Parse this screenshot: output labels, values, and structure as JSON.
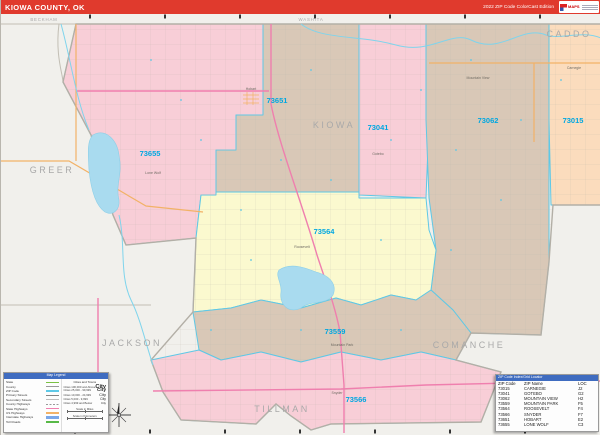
{
  "header": {
    "title": "KIOWA COUNTY, OK",
    "edition": "2022 ZIP Code ColorCast Edition",
    "logo_text": "MAPS"
  },
  "map": {
    "zip_labels": [
      "73651",
      "73041",
      "73062",
      "73015",
      "73655",
      "73564",
      "73559",
      "73566"
    ],
    "counties": [
      "BECKHAM",
      "WASHITA",
      "CADDO",
      "GREER",
      "KIOWA",
      "JACKSON",
      "TILLMAN",
      "COMANCHE"
    ],
    "towns": [
      "Hobart",
      "Lone Wolf",
      "Gotebo",
      "Mountain View",
      "Carnegie",
      "Roosevelt",
      "Mountain Park",
      "Snyder"
    ]
  },
  "legend": {
    "title": "Map Legend",
    "line_labels": [
      "State",
      "County",
      "ZIP Code",
      "Primary Streets",
      "Secondary Streets",
      "County Highways",
      "State Highways",
      "US Highways",
      "Interstate Highways",
      "Toll Roads"
    ],
    "cities_title": "Cities and Towns",
    "city_rows": [
      {
        "label": "Cities 100,000 and Above",
        "sample": "City"
      },
      {
        "label": "Cities 25,000 - 99,999",
        "sample": "City"
      },
      {
        "label": "Cities 10,000 - 24,999",
        "sample": "City"
      },
      {
        "label": "Cities 5,000 - 9,999",
        "sample": "City"
      },
      {
        "label": "Cities 4,999 and Below",
        "sample": "City"
      }
    ],
    "scale_miles": "Scale in Miles",
    "scale_km": "Scale in Kilometers"
  },
  "locator": {
    "title": "ZIP Code Index/Grid Locator",
    "columns": [
      "ZIP Code",
      "ZIP Name",
      "LOC"
    ],
    "rows": [
      [
        "73015",
        "CARNEGIE",
        "J2"
      ],
      [
        "73041",
        "GOTEBO",
        "G2"
      ],
      [
        "73062",
        "MOUNTAIN VIEW",
        "H2"
      ],
      [
        "73559",
        "MOUNTAIN PARK",
        "F5"
      ],
      [
        "73564",
        "ROOSEVELT",
        "F4"
      ],
      [
        "73566",
        "SNYDER",
        "F7"
      ],
      [
        "73651",
        "HOBART",
        "E2"
      ],
      [
        "73655",
        "LONE WOLF",
        "C3"
      ]
    ]
  },
  "colors": {
    "header_red": "#e03a2d",
    "bg_outside": "#f1f0ec",
    "pink": "#f8ced7",
    "tan": "#d9c8b7",
    "peach": "#fbdcbd",
    "yellow": "#fbf9cf",
    "water": "#a9dbef",
    "boundary_cyan": "#5ec8e6",
    "road_magenta": "#ef7fae",
    "road_orange": "#f2b267",
    "zip_label": "#00a7e1",
    "county_label": "#a9a9a9",
    "table_blue": "#3f6cc0",
    "legend_green": "#7ac143",
    "interstate_blue": "#7aa7e8",
    "toll_green": "#58b947"
  }
}
